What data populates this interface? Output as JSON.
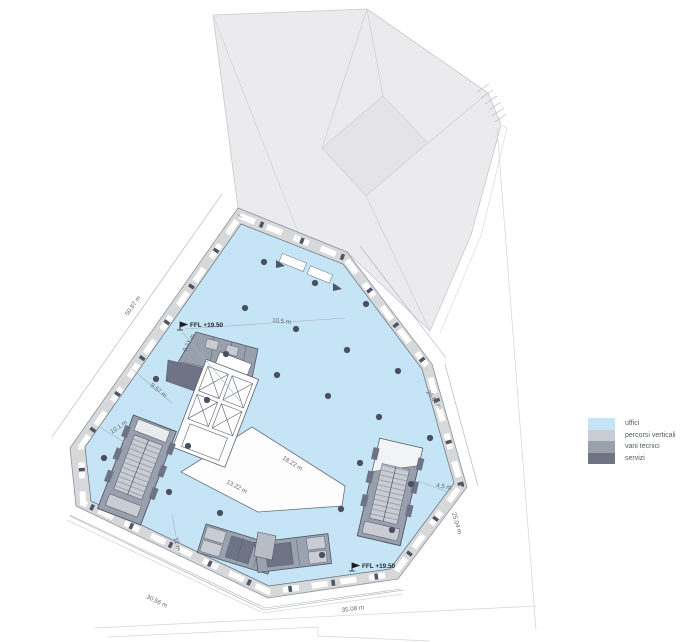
{
  "legend": {
    "items": [
      {
        "label": "uffici",
        "color": "#c5e4f5"
      },
      {
        "label": "percorsi verticali",
        "color": "#c9cdd3"
      },
      {
        "label": "vani tecnici",
        "color": "#9aa1ad"
      },
      {
        "label": "servizi",
        "color": "#6e7484"
      }
    ]
  },
  "levels": [
    {
      "label": "FFL +19.50",
      "x": 188,
      "y": 327
    },
    {
      "label": "FFL +19.50",
      "x": 360,
      "y": 568
    }
  ],
  "dimensions": [
    {
      "text": "50.87 m",
      "x": 128,
      "y": 316,
      "rot": -55
    },
    {
      "text": "10.5 m",
      "x": 272,
      "y": 322,
      "rot": 6
    },
    {
      "text": "9.71 m",
      "x": 186,
      "y": 352,
      "rot": -62
    },
    {
      "text": "9.57 m",
      "x": 150,
      "y": 386,
      "rot": 38
    },
    {
      "text": "10.1 m",
      "x": 112,
      "y": 434,
      "rot": -35
    },
    {
      "text": "26.89 m",
      "x": 426,
      "y": 392,
      "rot": 53
    },
    {
      "text": "18.22 m",
      "x": 282,
      "y": 459,
      "rot": 32
    },
    {
      "text": "13.22 m",
      "x": 226,
      "y": 483,
      "rot": 28
    },
    {
      "text": "11 m",
      "x": 174,
      "y": 538,
      "rot": 78
    },
    {
      "text": "4.5 m",
      "x": 436,
      "y": 487,
      "rot": 10
    },
    {
      "text": "25.04 m",
      "x": 452,
      "y": 513,
      "rot": 74
    },
    {
      "text": "30.56 m",
      "x": 146,
      "y": 598,
      "rot": 26
    },
    {
      "text": "35.08 m",
      "x": 342,
      "y": 612,
      "rot": -7
    }
  ],
  "columns": [
    [
      264,
      262
    ],
    [
      315,
      283
    ],
    [
      366,
      304
    ],
    [
      245,
      308
    ],
    [
      296,
      329
    ],
    [
      347,
      350
    ],
    [
      398,
      371
    ],
    [
      226,
      354
    ],
    [
      277,
      375
    ],
    [
      328,
      396
    ],
    [
      379,
      417
    ],
    [
      430,
      438
    ],
    [
      207,
      400
    ],
    [
      360,
      463
    ],
    [
      411,
      484
    ],
    [
      188,
      446
    ],
    [
      341,
      509
    ],
    [
      392,
      530
    ],
    [
      169,
      492
    ],
    [
      220,
      513
    ],
    [
      322,
      555
    ],
    [
      104,
      458
    ],
    [
      156,
      379
    ]
  ],
  "colors": {
    "office": "#c5e4f5",
    "wall": "#d7d8da",
    "core": "#98a0ad",
    "dark": "#6e7485",
    "column": "#4a5060",
    "dimline": "#a9aeb5",
    "text": "#5f646d"
  }
}
